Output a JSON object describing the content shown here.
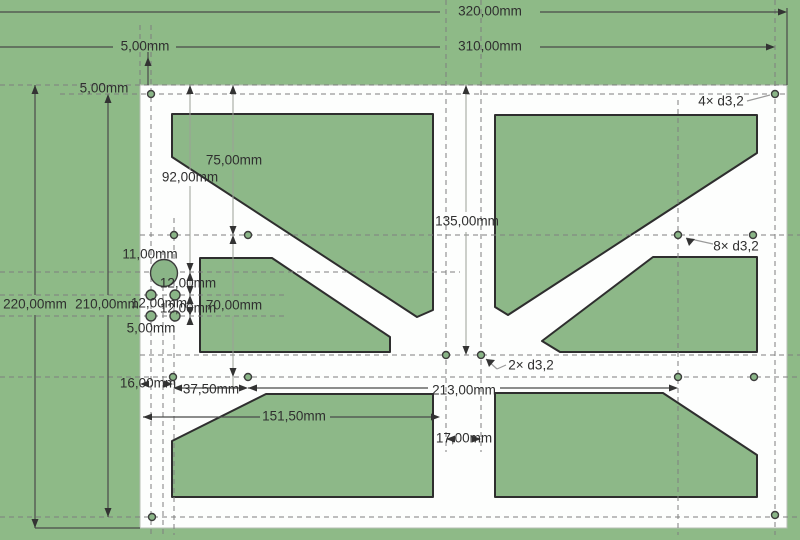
{
  "app": {
    "view_title": "cad-drawing-viewport"
  },
  "drawing": {
    "canvas": {
      "w": 800,
      "h": 540
    },
    "colors": {
      "background": "#8eba87",
      "cutout_fill": "#8db888",
      "cutout_stroke": "#2e2e2e",
      "plate_fill": "#fdfefd",
      "plate_stroke": "#b7bdb4",
      "dash_line": "#7f7f7f",
      "dim_line": "#4a4a4a",
      "ext_line": "#9aa096",
      "leader_line": "#9a9a9a",
      "arrow": "#333333",
      "hole_fill": "#8ab587",
      "hole_stroke": "#3c3c3c",
      "text": "#2f2f2f"
    },
    "plate": {
      "x": 140,
      "y": 85,
      "w": 647,
      "h": 443
    },
    "cutouts": [
      [
        [
          172,
          114
        ],
        [
          433,
          114
        ],
        [
          433,
          310
        ],
        [
          417,
          317
        ],
        [
          172,
          157
        ]
      ],
      [
        [
          495,
          115
        ],
        [
          757,
          115
        ],
        [
          757,
          153
        ],
        [
          508,
          315
        ],
        [
          495,
          307
        ]
      ],
      [
        [
          200,
          258
        ],
        [
          272,
          258
        ],
        [
          390,
          337
        ],
        [
          390,
          352
        ],
        [
          200,
          352
        ]
      ],
      [
        [
          653,
          257
        ],
        [
          757,
          257
        ],
        [
          757,
          352
        ],
        [
          560,
          352
        ],
        [
          542,
          341
        ]
      ],
      [
        [
          266,
          394
        ],
        [
          433,
          394
        ],
        [
          433,
          497
        ],
        [
          172,
          497
        ],
        [
          172,
          441
        ]
      ],
      [
        [
          495,
          393
        ],
        [
          663,
          393
        ],
        [
          757,
          455
        ],
        [
          757,
          497
        ],
        [
          495,
          497
        ]
      ]
    ],
    "holes": [
      [
        151,
        94,
        3.5
      ],
      [
        775,
        94,
        3.5
      ],
      [
        152,
        517,
        3.5
      ],
      [
        775,
        515,
        3.5
      ],
      [
        174,
        235,
        3.5
      ],
      [
        248,
        235,
        3.5
      ],
      [
        678,
        235,
        3.5
      ],
      [
        753,
        235,
        3.5
      ],
      [
        173,
        377,
        3.5
      ],
      [
        248,
        377,
        3.5
      ],
      [
        678,
        377,
        3.5
      ],
      [
        754,
        377,
        3.5
      ],
      [
        446,
        355,
        3.5
      ],
      [
        481,
        355,
        3.5
      ],
      [
        151,
        295,
        5
      ],
      [
        175,
        295,
        5
      ],
      [
        151,
        316,
        5
      ],
      [
        175,
        316,
        5
      ],
      [
        164,
        273,
        13.5
      ]
    ],
    "dashed_h": [
      [
        0,
        787,
        85
      ],
      [
        60,
        787,
        94
      ],
      [
        140,
        800,
        235
      ],
      [
        0,
        460,
        272
      ],
      [
        0,
        285,
        295
      ],
      [
        0,
        285,
        316
      ],
      [
        140,
        800,
        355
      ],
      [
        0,
        800,
        377
      ],
      [
        0,
        800,
        517
      ]
    ],
    "dashed_v": [
      [
        25,
        85,
        140
      ],
      [
        25,
        535,
        151
      ],
      [
        250,
        535,
        163
      ],
      [
        218,
        535,
        174
      ],
      [
        0,
        452,
        446
      ],
      [
        0,
        452,
        481
      ],
      [
        100,
        535,
        678
      ],
      [
        0,
        535,
        775
      ]
    ],
    "dim_lines": [
      [
        0,
        12,
        440,
        12
      ],
      [
        540,
        12,
        779,
        12
      ],
      [
        0,
        47,
        113,
        47
      ],
      [
        176,
        47,
        440,
        47
      ],
      [
        540,
        47,
        768,
        47
      ],
      [
        35,
        85,
        35,
        295
      ],
      [
        35,
        315,
        35,
        528
      ],
      [
        108,
        98,
        108,
        295
      ],
      [
        108,
        315,
        108,
        517
      ],
      [
        35,
        528,
        140,
        528
      ],
      [
        787,
        8,
        787,
        85
      ],
      [
        148,
        52,
        148,
        85
      ],
      [
        143,
        417,
        260,
        417
      ],
      [
        330,
        417,
        433,
        417
      ],
      [
        248,
        388,
        428,
        388
      ],
      [
        500,
        388,
        671,
        388
      ],
      [
        179,
        388,
        241,
        388
      ]
    ],
    "ext_lines": [
      [
        190,
        85,
        190,
        170
      ],
      [
        190,
        186,
        190,
        322
      ],
      [
        233,
        85,
        233,
        152
      ],
      [
        233,
        170,
        233,
        296
      ],
      [
        233,
        316,
        233,
        390
      ],
      [
        466,
        85,
        466,
        212
      ],
      [
        466,
        232,
        466,
        352
      ]
    ],
    "leader_lines": [
      [
        747,
        101,
        770,
        95
      ],
      [
        713,
        244,
        686,
        238
      ],
      [
        506,
        365,
        497,
        369
      ],
      [
        497,
        369,
        486,
        359
      ]
    ],
    "arrows": [
      [
        787,
        12,
        "r"
      ],
      [
        775,
        47,
        "r"
      ],
      [
        35,
        85,
        "u"
      ],
      [
        35,
        528,
        "d"
      ],
      [
        108,
        94,
        "u"
      ],
      [
        108,
        517,
        "d"
      ],
      [
        190,
        85,
        "u"
      ],
      [
        233,
        85,
        "u"
      ],
      [
        466,
        85,
        "u"
      ],
      [
        148,
        57,
        "u"
      ],
      [
        233,
        235,
        "u"
      ],
      [
        233,
        235,
        "d"
      ],
      [
        190,
        272,
        "u"
      ],
      [
        190,
        272,
        "d"
      ],
      [
        190,
        295,
        "u"
      ],
      [
        190,
        295,
        "d"
      ],
      [
        190,
        316,
        "u"
      ],
      [
        190,
        316,
        "d"
      ],
      [
        466,
        355,
        "d"
      ],
      [
        233,
        377,
        "d"
      ],
      [
        143,
        417,
        "l"
      ],
      [
        440,
        417,
        "r"
      ],
      [
        140,
        384,
        "l"
      ],
      [
        173,
        384,
        "r"
      ],
      [
        173,
        388,
        "l"
      ],
      [
        248,
        388,
        "r"
      ],
      [
        248,
        388,
        "l"
      ],
      [
        678,
        388,
        "r"
      ],
      [
        446,
        439,
        "l"
      ],
      [
        481,
        439,
        "r"
      ],
      [
        686,
        238,
        "ul"
      ],
      [
        486,
        359,
        "ul"
      ]
    ],
    "labels": [
      {
        "text": "320,00mm",
        "x": 490,
        "y": 12
      },
      {
        "text": "310,00mm",
        "x": 490,
        "y": 47
      },
      {
        "text": "5,00mm",
        "x": 145,
        "y": 47
      },
      {
        "text": "5,00mm",
        "x": 104,
        "y": 89
      },
      {
        "text": "4× d3,2",
        "x": 721,
        "y": 102
      },
      {
        "text": "92,00mm",
        "x": 190,
        "y": 178
      },
      {
        "text": "75,00mm",
        "x": 234,
        "y": 161
      },
      {
        "text": "135,00mm",
        "x": 467,
        "y": 222
      },
      {
        "text": "8× d3,2",
        "x": 736,
        "y": 247
      },
      {
        "text": "11,00mm",
        "x": 150,
        "y": 255
      },
      {
        "text": "12,00mm",
        "x": 188,
        "y": 284
      },
      {
        "text": "12,00mm",
        "x": 159,
        "y": 304
      },
      {
        "text": "12,00mm",
        "x": 188,
        "y": 309
      },
      {
        "text": "70,00mm",
        "x": 234,
        "y": 306
      },
      {
        "text": "220,00mm",
        "x": 35,
        "y": 305
      },
      {
        "text": "210,00mm",
        "x": 107,
        "y": 305
      },
      {
        "text": "5,00mm",
        "x": 151,
        "y": 329
      },
      {
        "text": "2× d3,2",
        "x": 531,
        "y": 366
      },
      {
        "text": "16,00mm",
        "x": 148,
        "y": 384
      },
      {
        "text": "37,50mm",
        "x": 211,
        "y": 390
      },
      {
        "text": "213,00mm",
        "x": 464,
        "y": 391
      },
      {
        "text": "151,50mm",
        "x": 294,
        "y": 417
      },
      {
        "text": "17,00mm",
        "x": 464,
        "y": 439
      }
    ]
  }
}
